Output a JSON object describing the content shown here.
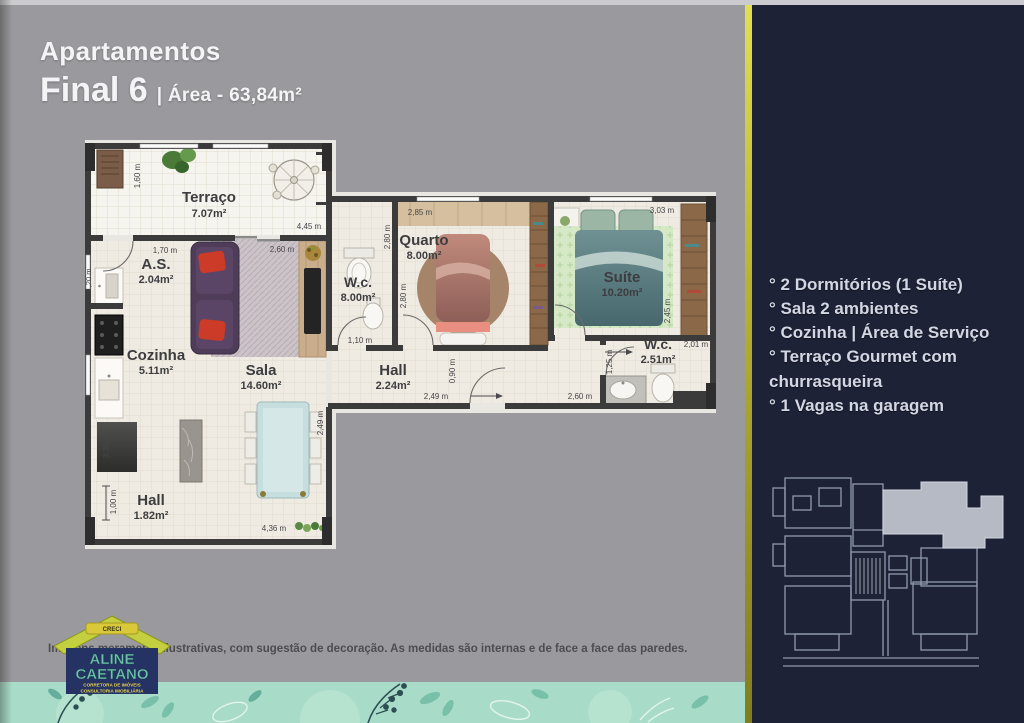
{
  "header": {
    "title": "Apartamentos",
    "unit": "Final 6",
    "area_label": "| Área - 63,84m²"
  },
  "sidebar": {
    "features": [
      "° 2 Dormitórios (1 Suíte)",
      "° Sala 2 ambientes",
      "° Cozinha | Área de Serviço",
      "° Terraço Gourmet com churrasqueira",
      "° 1 Vagas na garagem"
    ]
  },
  "floorplan": {
    "rooms": {
      "terraco": {
        "name": "Terraço",
        "area": "7.07m²"
      },
      "servico": {
        "name": "A.S.",
        "area": "2.04m²"
      },
      "cozinha": {
        "name": "Cozinha",
        "area": "5.11m²"
      },
      "sala": {
        "name": "Sala",
        "area": "14.60m²"
      },
      "hall_entrada": {
        "name": "Hall",
        "area": "1.82m²"
      },
      "hall_intimo": {
        "name": "Hall",
        "area": "2.24m²"
      },
      "wc_social": {
        "name": "W.c.",
        "area": "8.00m²"
      },
      "quarto": {
        "name": "Quarto",
        "area": "8.00m²"
      },
      "suite": {
        "name": "Suíte",
        "area": "10.20m²"
      },
      "wc_suite": {
        "name": "W.c.",
        "area": "2.51m²"
      }
    },
    "dims": {
      "d160": "1,60 m",
      "d445": "4,45 m",
      "d170": "1,70 m",
      "d120": "1,20 m",
      "d260_sala": "2,60 m",
      "d285": "2,85 m",
      "d303": "3,03 m",
      "d280_wc": "2,80 m",
      "d280_quarto": "2,80 m",
      "d245": "2,45 m",
      "d110": "1,10 m",
      "d090": "0,90 m",
      "d249_hall": "2,49 m",
      "d249_sala": "2,49 m",
      "d260_hall": "2,60 m",
      "d125": "1,25 m",
      "d201": "2,01 m",
      "d100": "1,00 m",
      "d436": "4,36 m",
      "d320": "3,20 m"
    }
  },
  "footer": {
    "disclaimer": "Imagens meramente ilustrativas, com sugestão de decoração. As medidas são internas e de face a face das paredes."
  },
  "logo": {
    "banner": "CRECI",
    "name_line1": "ALINE",
    "name_line2": "CAETANO",
    "tagline1": "CORRETORA DE IMÓVEIS",
    "tagline2": "CONSULTORIA IMOBILIÁRIA"
  },
  "colors": {
    "panel": "#1e2236",
    "accent": "#b7b133",
    "background": "#9a9a9e",
    "floral": "#a9dcc8"
  }
}
